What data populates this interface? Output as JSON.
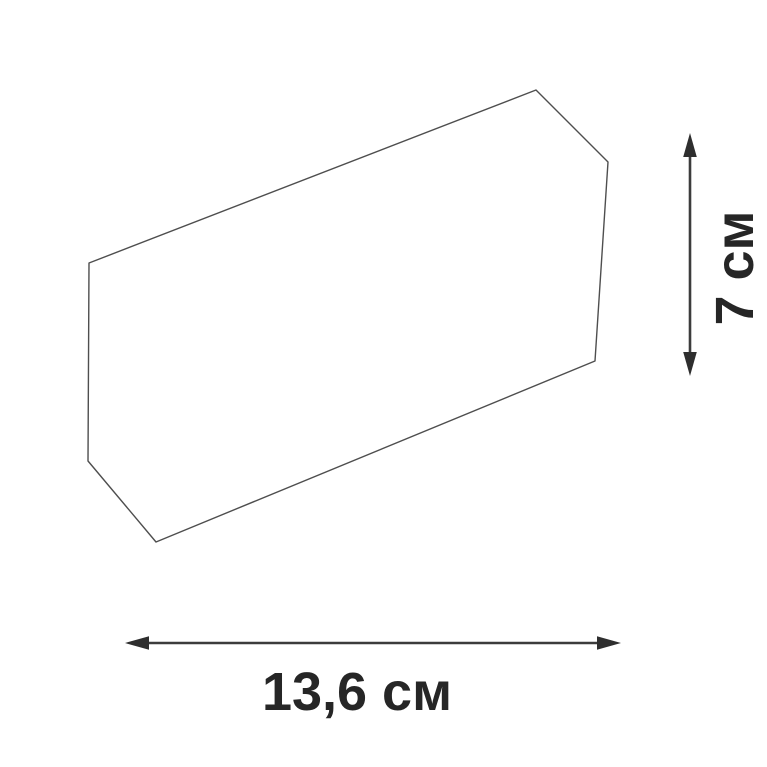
{
  "diagram": {
    "type": "product-dimension-drawing",
    "shape": "hexagonal-panel-outline",
    "dimensions": {
      "width": {
        "label": "13,6 см",
        "value": "13,6",
        "unit": "см"
      },
      "height": {
        "label": "7 см",
        "value": "7",
        "unit": "см"
      }
    },
    "colors": {
      "background": "#ffffff",
      "outline": "#4e4e4e",
      "arrow": "#343434",
      "text": "#262626"
    }
  }
}
